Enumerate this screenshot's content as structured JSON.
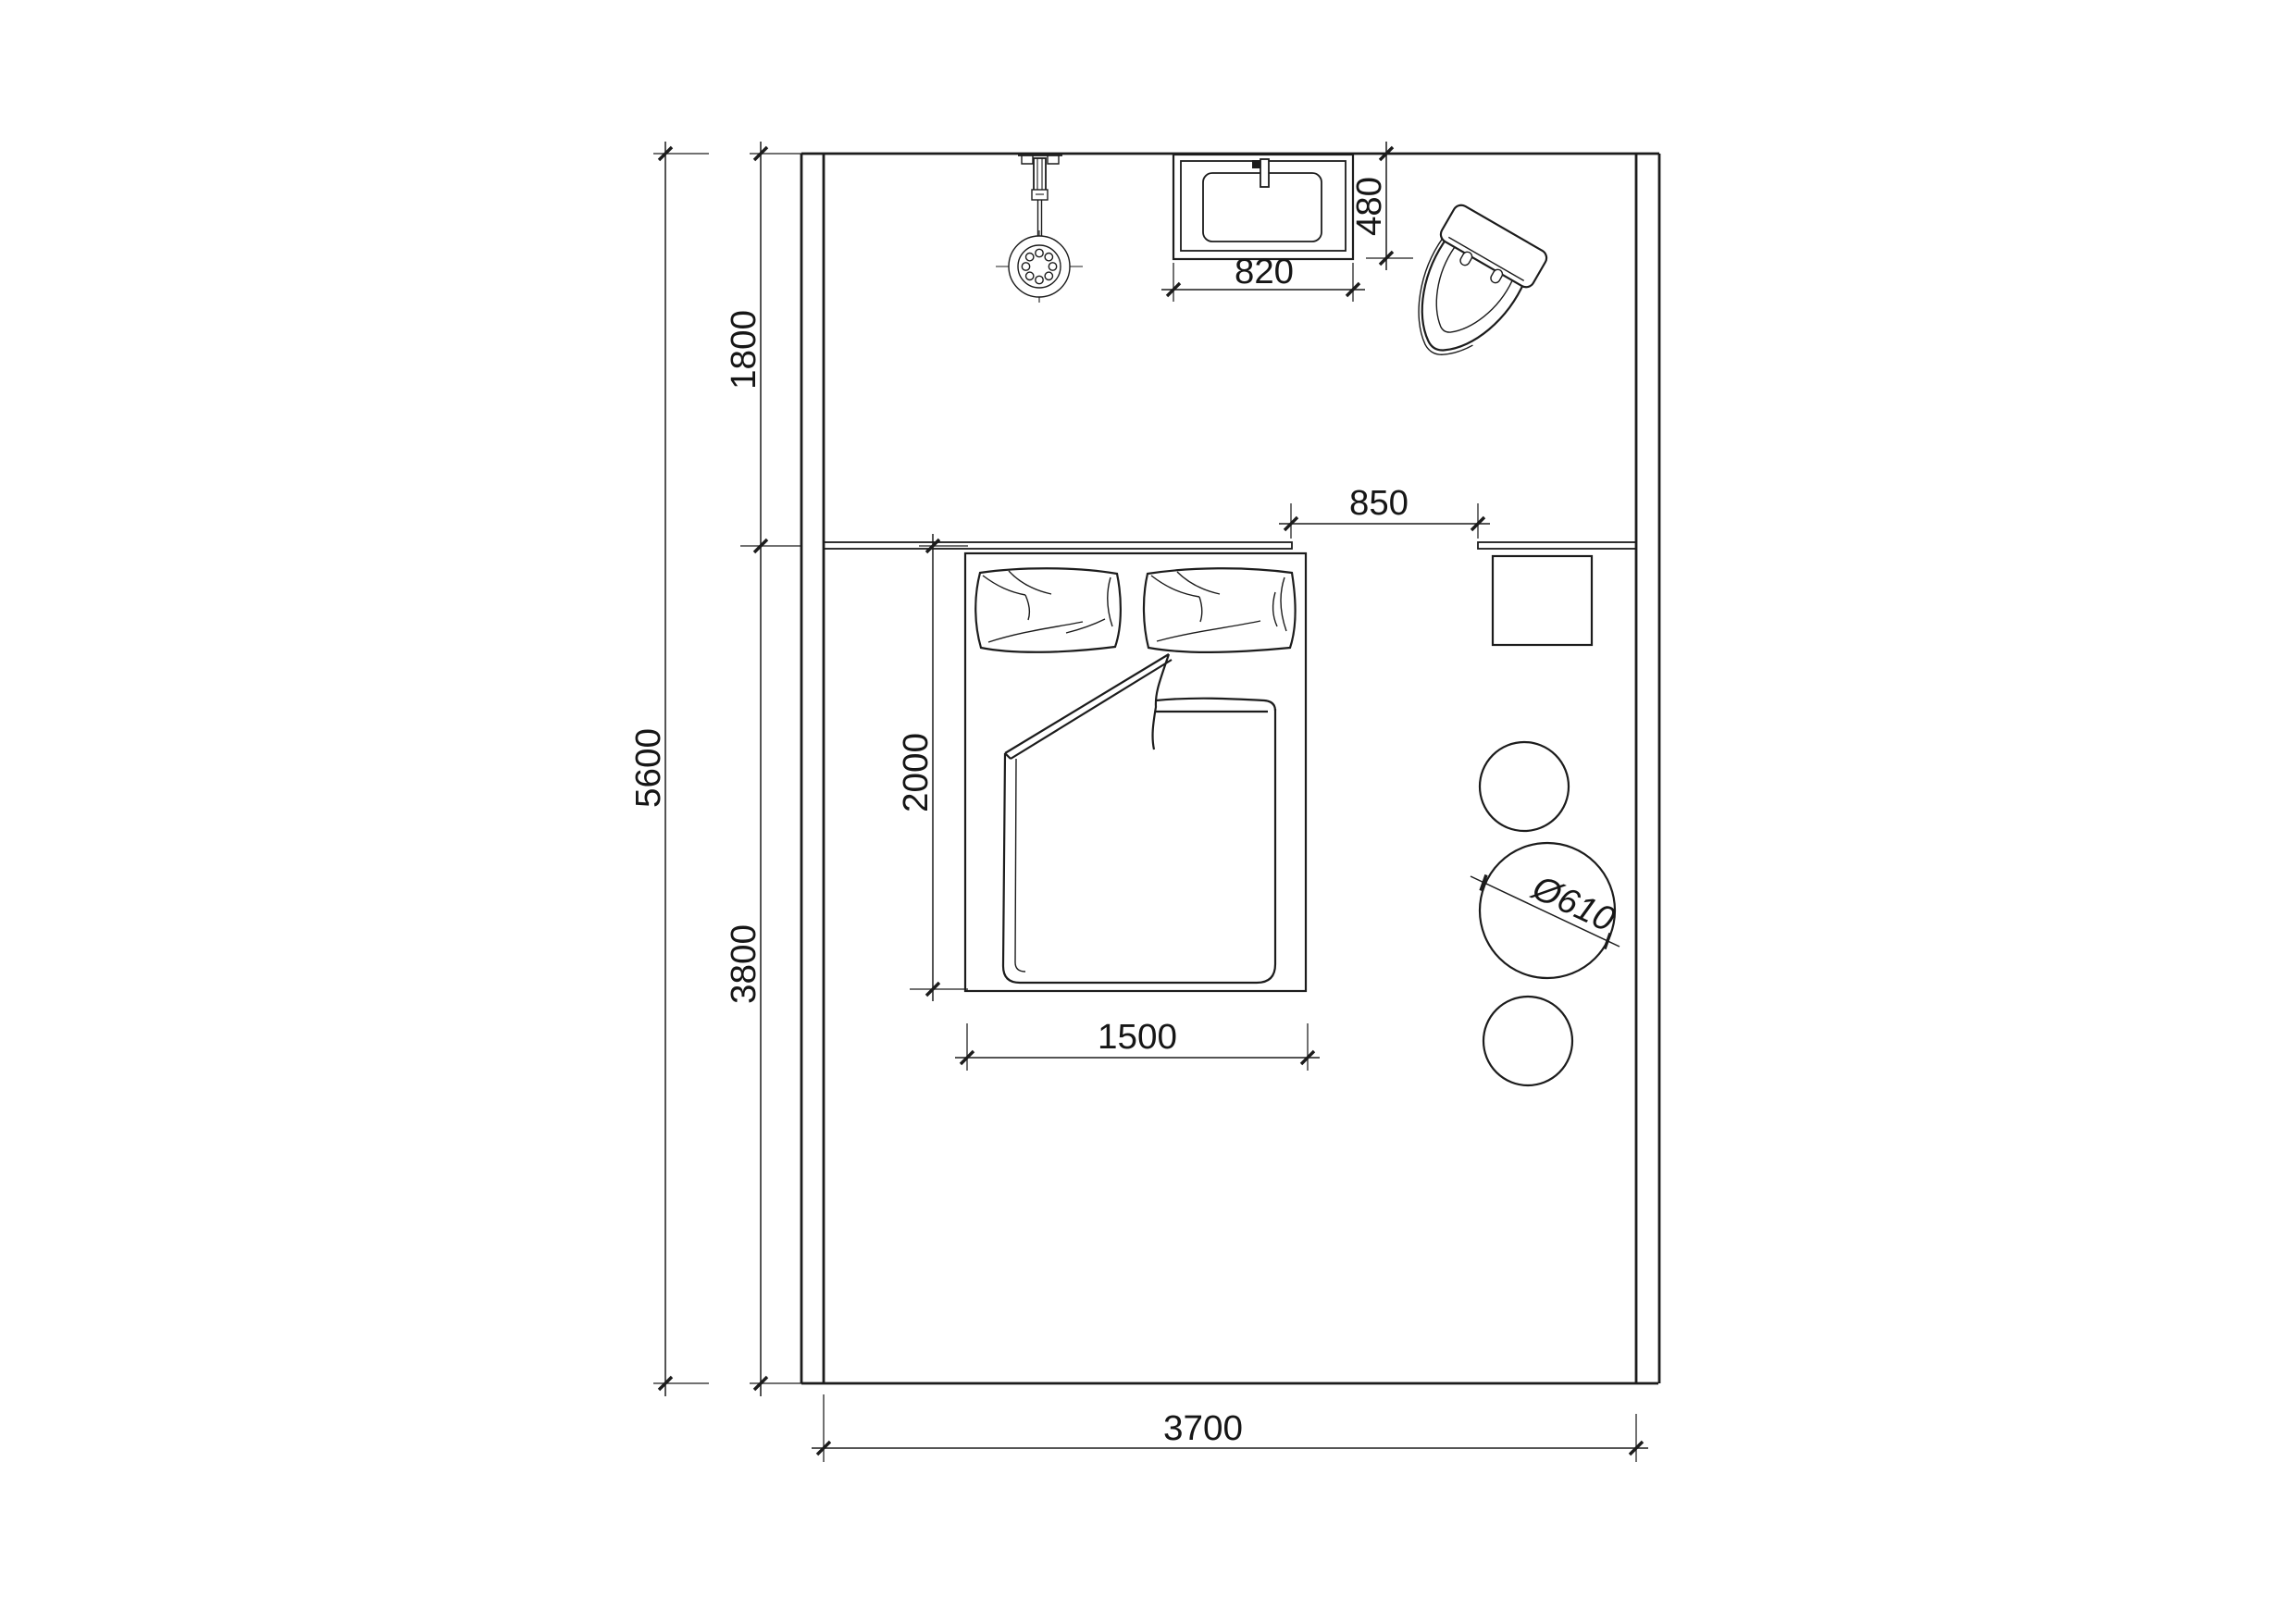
{
  "dims": {
    "room_height": "5600",
    "zone_top": "1800",
    "zone_bottom": "3800",
    "room_width": "3700",
    "walkway": "850",
    "basin_width": "820",
    "basin_depth": "480",
    "bed_width": "1500",
    "bed_length": "2000",
    "table_diameter": "Ø610"
  }
}
